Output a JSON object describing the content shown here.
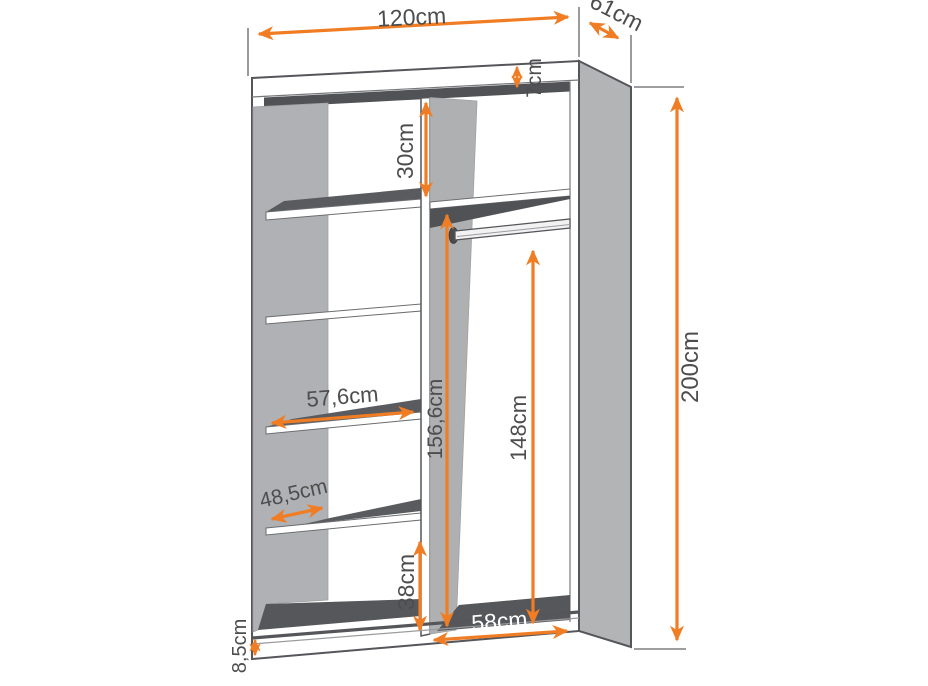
{
  "diagram": {
    "title": "Two-section sliding wardrobe dimension diagram",
    "unit": "cm",
    "labels": {
      "width": "120cm",
      "depth": "61cm",
      "top_panel_thickness": "7cm",
      "top_shelf_gap": "30cm",
      "height": "200cm",
      "interior_height": "156,6cm",
      "hanging_space_height": "148cm",
      "shelf_width": "57,6cm",
      "shelf_depth": "48,5cm",
      "bottom_shelf_gap": "38cm",
      "hanging_section_width": "58cm",
      "plinth_height": "8,5cm"
    },
    "colors": {
      "accent_orange": "#F07D23",
      "label_gray": "#4D4D4E",
      "panel_gray": "#B3B4B6",
      "divider_gray": "#AEB0B2",
      "dark_surface": "#56575A",
      "outline": "#55565A"
    }
  }
}
